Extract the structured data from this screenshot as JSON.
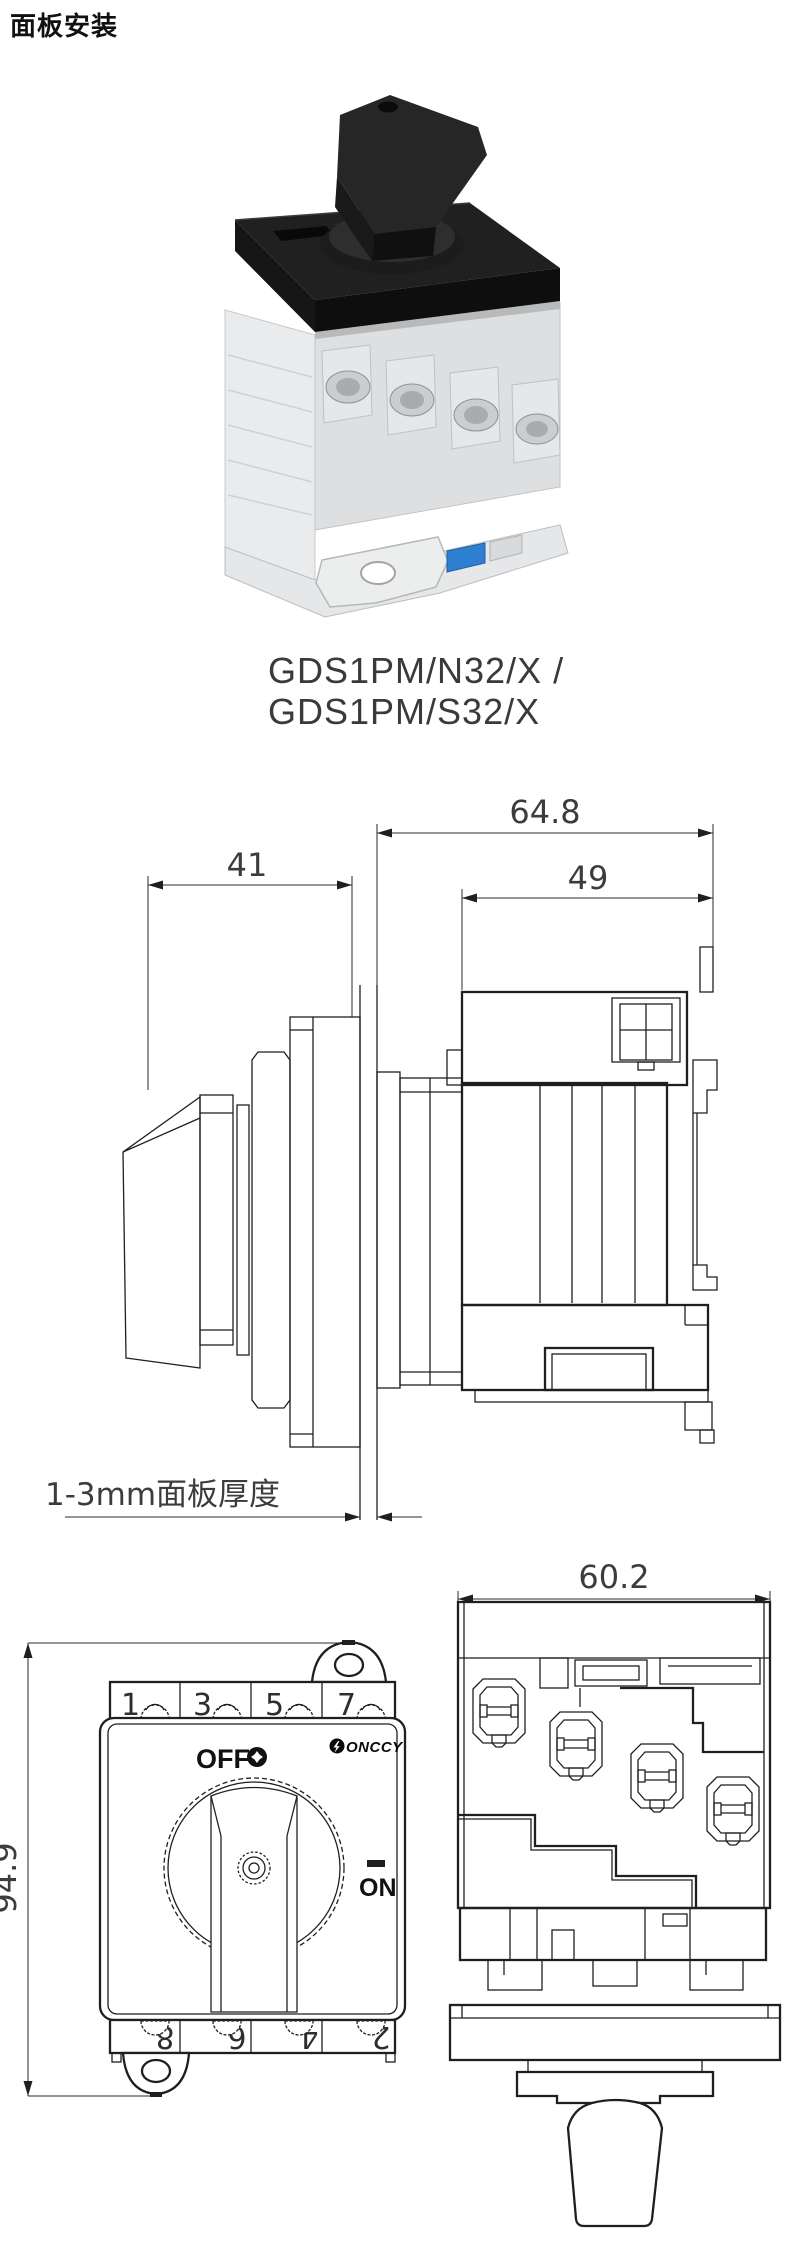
{
  "page": {
    "title": "面板安装"
  },
  "product": {
    "model_line1": "GDS1PM/N32/X  /",
    "model_line2": "GDS1PM/S32/X"
  },
  "side_view": {
    "dim_total_depth": "64.8",
    "dim_handle_depth": "41",
    "dim_body_depth": "49",
    "panel_note": "1-3mm面板厚度"
  },
  "front_view": {
    "dim_height": "94.9",
    "label_off": "OFF",
    "label_on": "ON",
    "brand": "ONCCY",
    "terminals_top": [
      "1",
      "3",
      "5",
      "7"
    ],
    "terminals_bottom": [
      "8",
      "6",
      "4",
      "2"
    ]
  },
  "top_view": {
    "dim_width": "60.2"
  },
  "colors": {
    "line": "#1f1f1f",
    "handle_black": "#222222",
    "body_gray": "#e2e3e4",
    "din_clip_blue": "#2f7fd0"
  }
}
